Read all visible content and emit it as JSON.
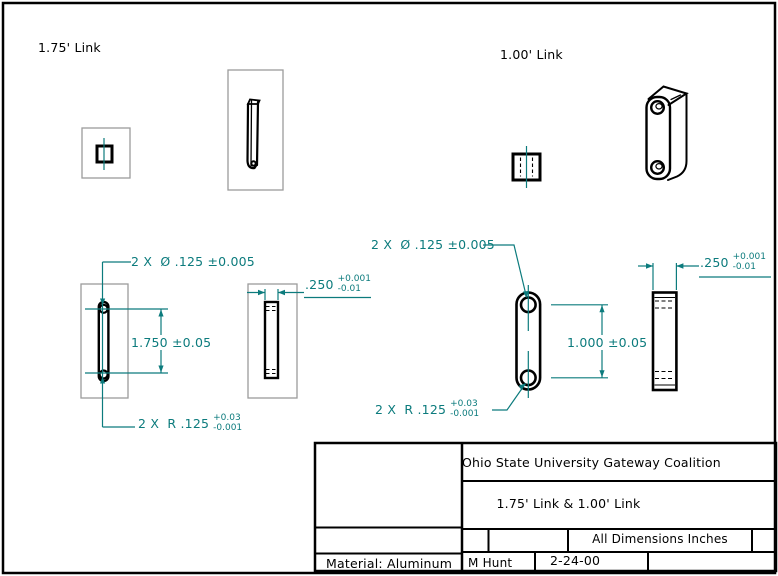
{
  "labels": {
    "left_view_label": "1.75' Link",
    "right_view_label": "1.00' Link"
  },
  "dimensions": {
    "left": {
      "holes": "2 X  Ø .125 ±0.005",
      "length": "1.750 ±0.05",
      "radius_prefix": "2 X  R .125",
      "radius_plus": "+0.03",
      "radius_minus": "-0.001",
      "width": ".250",
      "width_plus": "+0.001",
      "width_minus": "-0.01"
    },
    "right": {
      "holes": "2 X  Ø .125 ±0.005",
      "length": "1.000 ±0.05",
      "radius_prefix": "2 X  R .125",
      "radius_plus": "+0.03",
      "radius_minus": "-0.001",
      "width": ".250",
      "width_plus": "+0.001",
      "width_minus": "-0.01"
    }
  },
  "title_block": {
    "company": "Ohio State University Gateway Coalition",
    "drawing_title": "1.75' Link & 1.00' Link",
    "units": "All Dimensions Inches",
    "material": "Material: Aluminum",
    "author": "M Hunt",
    "date": "2-24-00"
  },
  "colors": {
    "dimension_teal": "#0c7b7d",
    "outline_black": "#000000",
    "view_box_gray": "#9c9c9c"
  }
}
